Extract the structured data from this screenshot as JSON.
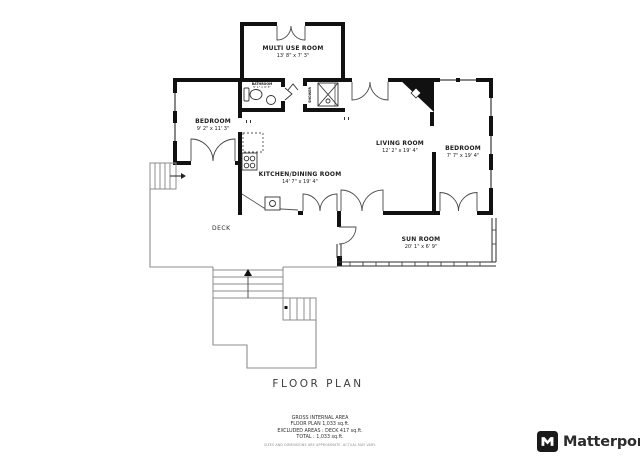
{
  "title": "FLOOR PLAN",
  "rooms": {
    "multi_use": {
      "name": "MULTI USE ROOM",
      "dims": "13' 8\" x 7' 3\""
    },
    "bedroom_left": {
      "name": "BEDROOM",
      "dims": "9' 2\" x 11' 3\""
    },
    "living": {
      "name": "LIVING ROOM",
      "dims": "12' 2\" x 19' 4\""
    },
    "bedroom_right": {
      "name": "BEDROOM",
      "dims": "7' 7\" x 19' 4\""
    },
    "kitchen": {
      "name": "KITCHEN/DINING ROOM",
      "dims": "14' 7\" x 19' 4\""
    },
    "sun_room": {
      "name": "SUN ROOM",
      "dims": "20' 1\" x 6' 9\""
    },
    "bathroom": {
      "name": "BATHROOM",
      "dims": "5' 1\" x 4' 3\""
    },
    "shower": {
      "name": "SHOWER"
    },
    "deck": {
      "name": "DECK"
    }
  },
  "footer": {
    "line1": "GROSS INTERNAL AREA",
    "line2": "FLOOR PLAN 1,033 sq.ft.",
    "line3": "EXCLUDED AREAS : DECK 417 sq.ft.",
    "line4": "TOTAL : 1,033 sq.ft.",
    "disclaimer": "SIZES AND DIMENSIONS ARE APPROXIMATE, ACTUAL MAY VARY."
  },
  "brand": {
    "name": "Matterport"
  },
  "colors": {
    "wall": "#111111",
    "fixture": "#333333",
    "deck_line": "#8e8e8e",
    "text": "#1d1d1d"
  }
}
